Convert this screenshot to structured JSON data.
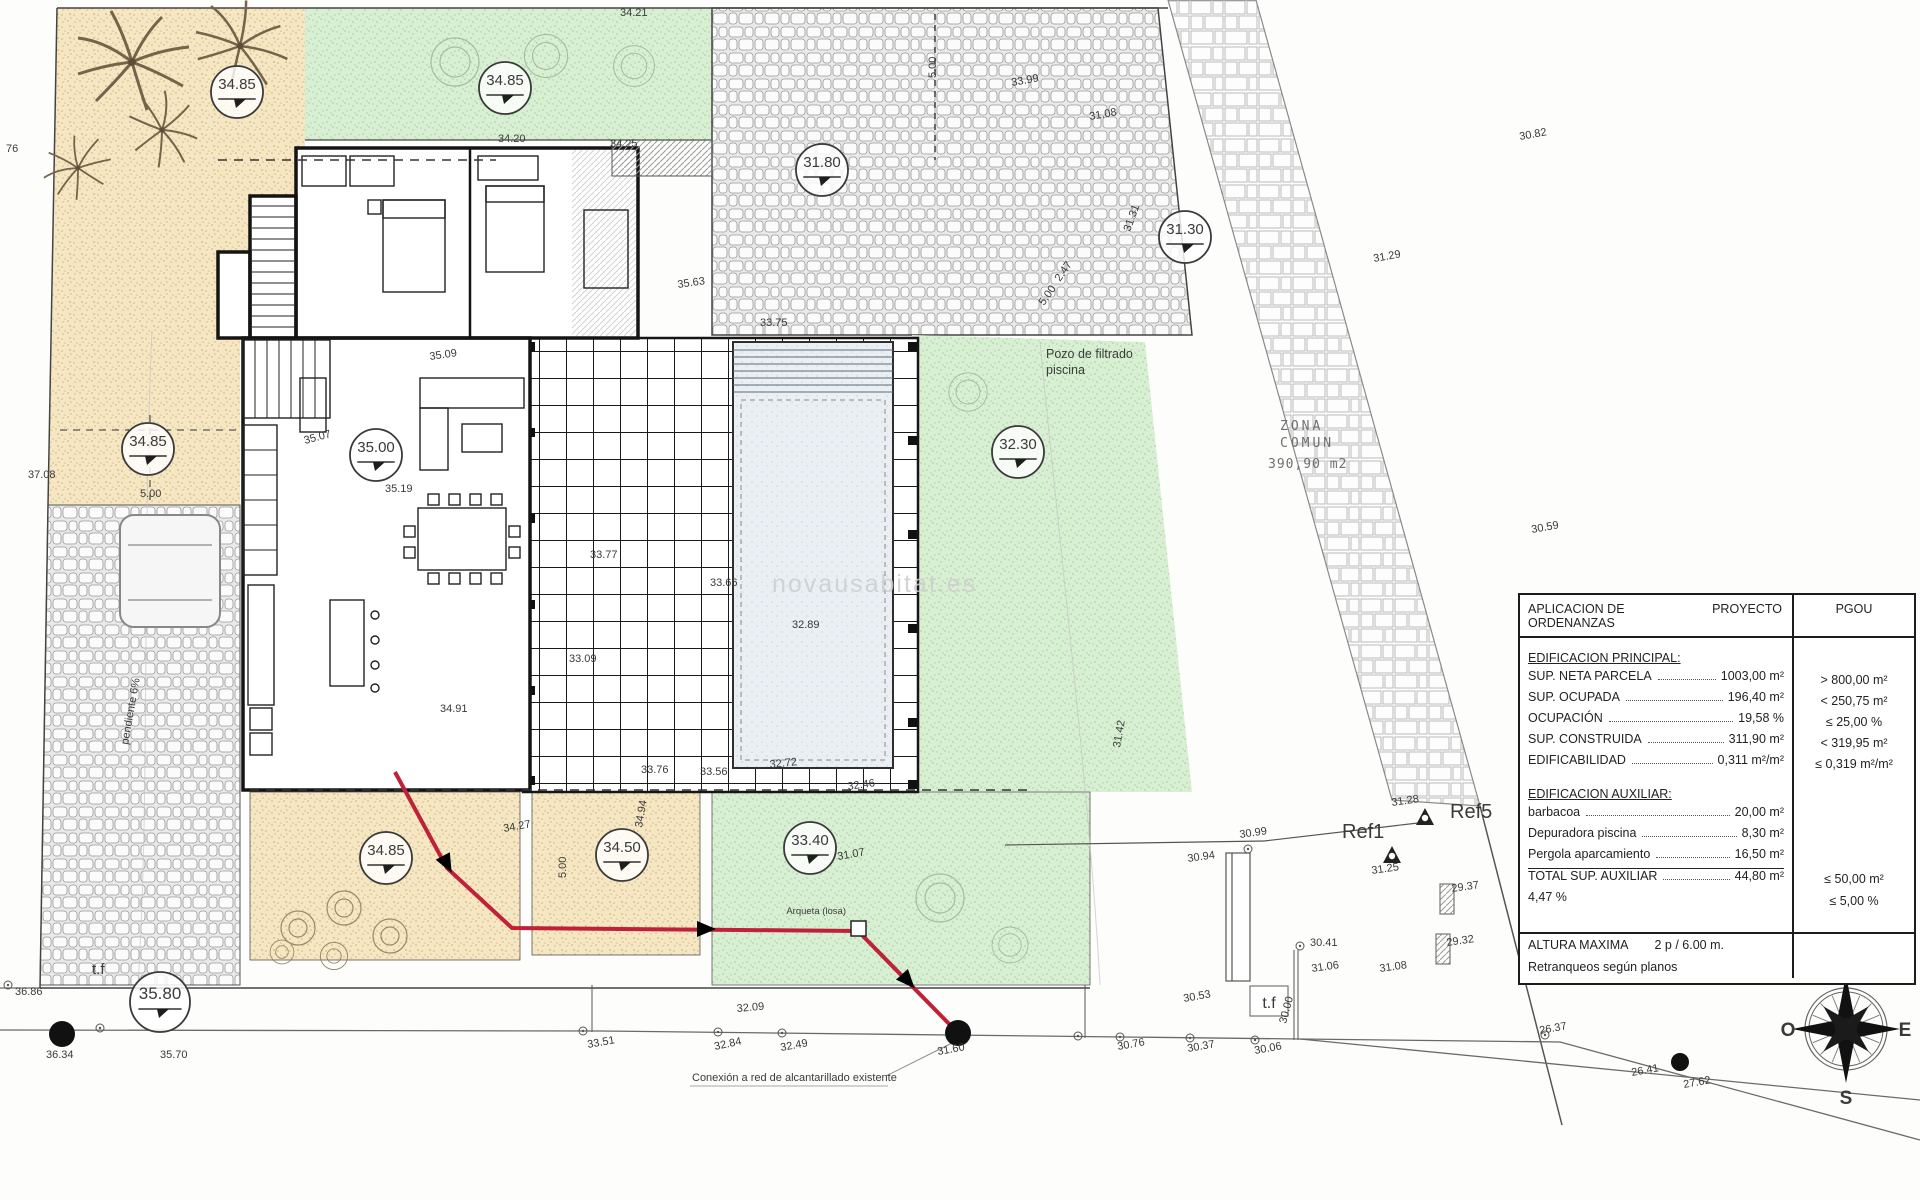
{
  "drawing": {
    "watermark": "novausabitat.es",
    "zona_comun": {
      "l1": "ZONA",
      "l2": "COMUN",
      "l3": "390,90 m2"
    },
    "labels": {
      "pozo_l1": "Pozo de filtrado",
      "pozo_l2": "piscina",
      "conexion": "Conexión a red de alcantarillado existente",
      "arqueta": "Arqueta (losa)",
      "pendiente": "pendiente 6%",
      "tf_left": "t.f",
      "tf_right": "t.f",
      "ref1": "Ref1",
      "ref5": "Ref5"
    },
    "elevation_markers": [
      {
        "x": 237,
        "y": 92,
        "v": "34.85"
      },
      {
        "x": 505,
        "y": 88,
        "v": "34.85"
      },
      {
        "x": 822,
        "y": 170,
        "v": "31.80"
      },
      {
        "x": 1185,
        "y": 237,
        "v": "31.30"
      },
      {
        "x": 148,
        "y": 449,
        "v": "34.85"
      },
      {
        "x": 376,
        "y": 455,
        "v": "35.00"
      },
      {
        "x": 1018,
        "y": 452,
        "v": "32.30"
      },
      {
        "x": 386,
        "y": 858,
        "v": "34.85"
      },
      {
        "x": 622,
        "y": 855,
        "v": "34.50"
      },
      {
        "x": 810,
        "y": 848,
        "v": "33.40"
      },
      {
        "x": 160,
        "y": 1002,
        "v": "35.80",
        "big": true
      }
    ],
    "survey_labels": [
      {
        "x": 6,
        "y": 152,
        "v": "76"
      },
      {
        "x": 28,
        "y": 478,
        "v": "37.08"
      },
      {
        "x": 15,
        "y": 995,
        "v": "36.86"
      },
      {
        "x": 46,
        "y": 1058,
        "v": "36.34"
      },
      {
        "x": 160,
        "y": 1058,
        "v": "35.70"
      },
      {
        "x": 498,
        "y": 142,
        "v": "34.20"
      },
      {
        "x": 610,
        "y": 147,
        "v": "34.25"
      },
      {
        "x": 620,
        "y": 16,
        "v": "34.21"
      },
      {
        "x": 430,
        "y": 360,
        "v": "35.09",
        "r": -8
      },
      {
        "x": 305,
        "y": 444,
        "v": "35.07",
        "r": -15
      },
      {
        "x": 385,
        "y": 492,
        "v": "35.19"
      },
      {
        "x": 440,
        "y": 712,
        "v": "34.91"
      },
      {
        "x": 590,
        "y": 558,
        "v": "33.77"
      },
      {
        "x": 710,
        "y": 586,
        "v": "33.66"
      },
      {
        "x": 569,
        "y": 662,
        "v": "33.09"
      },
      {
        "x": 792,
        "y": 628,
        "v": "32.89"
      },
      {
        "x": 641,
        "y": 773,
        "v": "33.76"
      },
      {
        "x": 700,
        "y": 775,
        "v": "33.56"
      },
      {
        "x": 770,
        "y": 768,
        "v": "32.72",
        "r": -6
      },
      {
        "x": 848,
        "y": 790,
        "v": "32.46",
        "r": -8
      },
      {
        "x": 760,
        "y": 326,
        "v": "33.75"
      },
      {
        "x": 678,
        "y": 288,
        "v": "35.63",
        "r": -8
      },
      {
        "x": 1012,
        "y": 86,
        "v": "33.99",
        "r": -10
      },
      {
        "x": 1090,
        "y": 120,
        "v": "31.08",
        "r": -10
      },
      {
        "x": 1130,
        "y": 232,
        "v": "31.31",
        "r": -70
      },
      {
        "x": 1060,
        "y": 282,
        "v": "2.47",
        "r": -55
      },
      {
        "x": 1044,
        "y": 306,
        "v": "5.00",
        "r": -55
      },
      {
        "x": 936,
        "y": 78,
        "v": "5.00",
        "r": -90
      },
      {
        "x": 566,
        "y": 878,
        "v": "5.00",
        "r": -90
      },
      {
        "x": 140,
        "y": 497,
        "v": "5.00"
      },
      {
        "x": 504,
        "y": 832,
        "v": "34.27",
        "r": -10
      },
      {
        "x": 642,
        "y": 828,
        "v": "34.94",
        "r": -80
      },
      {
        "x": 838,
        "y": 860,
        "v": "31.07",
        "r": -10
      },
      {
        "x": 1120,
        "y": 748,
        "v": "31.42",
        "r": -80
      },
      {
        "x": 1520,
        "y": 140,
        "v": "30.82",
        "r": -10
      },
      {
        "x": 1374,
        "y": 262,
        "v": "31.29",
        "r": -10
      },
      {
        "x": 1532,
        "y": 533,
        "v": "30.59",
        "r": -10
      },
      {
        "x": 1240,
        "y": 838,
        "v": "30.99",
        "r": -8
      },
      {
        "x": 1188,
        "y": 862,
        "v": "30.94",
        "r": -8
      },
      {
        "x": 1392,
        "y": 806,
        "v": "31.28",
        "r": -8
      },
      {
        "x": 1372,
        "y": 874,
        "v": "31.25",
        "r": -8
      },
      {
        "x": 1452,
        "y": 892,
        "v": "29.37",
        "r": -8
      },
      {
        "x": 1447,
        "y": 946,
        "v": "29.32",
        "r": -8
      },
      {
        "x": 1310,
        "y": 946,
        "v": "30.41"
      },
      {
        "x": 1312,
        "y": 972,
        "v": "31.06",
        "r": -8
      },
      {
        "x": 1380,
        "y": 972,
        "v": "31.08",
        "r": -8
      },
      {
        "x": 1184,
        "y": 1002,
        "v": "30.53",
        "r": -10
      },
      {
        "x": 1286,
        "y": 1024,
        "v": "30.00",
        "r": -75
      },
      {
        "x": 588,
        "y": 1048,
        "v": "33.51",
        "r": -10
      },
      {
        "x": 715,
        "y": 1050,
        "v": "32.84",
        "r": -12
      },
      {
        "x": 781,
        "y": 1051,
        "v": "32.49",
        "r": -10
      },
      {
        "x": 938,
        "y": 1055,
        "v": "31.60",
        "r": -10
      },
      {
        "x": 1118,
        "y": 1050,
        "v": "30.76",
        "r": -10
      },
      {
        "x": 1188,
        "y": 1052,
        "v": "30.37",
        "r": -10
      },
      {
        "x": 1255,
        "y": 1054,
        "v": "30.06",
        "r": -10
      },
      {
        "x": 1540,
        "y": 1034,
        "v": "26.37",
        "r": -10
      },
      {
        "x": 1632,
        "y": 1076,
        "v": "26.41",
        "r": -10
      },
      {
        "x": 1684,
        "y": 1088,
        "v": "27.62",
        "r": -10
      },
      {
        "x": 737,
        "y": 1012,
        "v": "32.09",
        "r": -5
      }
    ],
    "survey_ticks": [
      [
        8,
        985
      ],
      [
        583,
        1031
      ],
      [
        718,
        1032
      ],
      [
        782,
        1033
      ],
      [
        1078,
        1036
      ],
      [
        1120,
        1037
      ],
      [
        1190,
        1038
      ],
      [
        1255,
        1040
      ],
      [
        1300,
        946
      ],
      [
        1248,
        849
      ],
      [
        1545,
        1035
      ],
      [
        100,
        1028
      ]
    ],
    "black_dots": [
      [
        958,
        1033,
        13
      ],
      [
        62,
        1034,
        13
      ],
      [
        1680,
        1062,
        9
      ]
    ]
  },
  "table": {
    "header": {
      "col1": "APLICACION DE ORDENANZAS",
      "col2": "PROYECTO",
      "col3": "PGOU"
    },
    "sections": [
      {
        "title": "EDIFICACION PRINCIPAL:",
        "rows": [
          {
            "label": "SUP. NETA PARCELA",
            "proyecto": "1003,00 m²",
            "pgou": "> 800,00 m²"
          },
          {
            "label": "SUP. OCUPADA",
            "proyecto": "196,40 m²",
            "pgou": "< 250,75 m²"
          },
          {
            "label": "OCUPACIÓN",
            "proyecto": "19,58 %",
            "pgou": "≤ 25,00 %"
          },
          {
            "label": "SUP. CONSTRUIDA",
            "proyecto": "311,90 m²",
            "pgou": "< 319,95 m²"
          },
          {
            "label": "EDIFICABILIDAD",
            "proyecto": "0,311 m²/m²",
            "pgou": "≤ 0,319 m²/m²"
          }
        ]
      },
      {
        "title": "EDIFICACION AUXILIAR:",
        "rows": [
          {
            "label": "barbacoa",
            "proyecto": "20,00 m²",
            "pgou": ""
          },
          {
            "label": "Depuradora piscina",
            "proyecto": "8,30 m²",
            "pgou": ""
          },
          {
            "label": "Pergola aparcamiento",
            "proyecto": "16,50 m²",
            "pgou": ""
          },
          {
            "label": "TOTAL SUP. AUXILIAR",
            "proyecto": "44,80 m²",
            "pgou": "≤ 50,00 m²",
            "total": true
          },
          {
            "label": "",
            "proyecto": "4,47 %",
            "pgou": "≤ 5,00 %"
          }
        ]
      },
      {
        "rows": [
          {
            "plain": "ALTURA MAXIMA",
            "plain2": "2 p / 6.00 m.",
            "sep": true
          },
          {
            "plain": "Retranqueos según planos"
          }
        ]
      }
    ]
  },
  "compass": {
    "n": "N",
    "s": "S",
    "e": "E",
    "o": "O"
  }
}
